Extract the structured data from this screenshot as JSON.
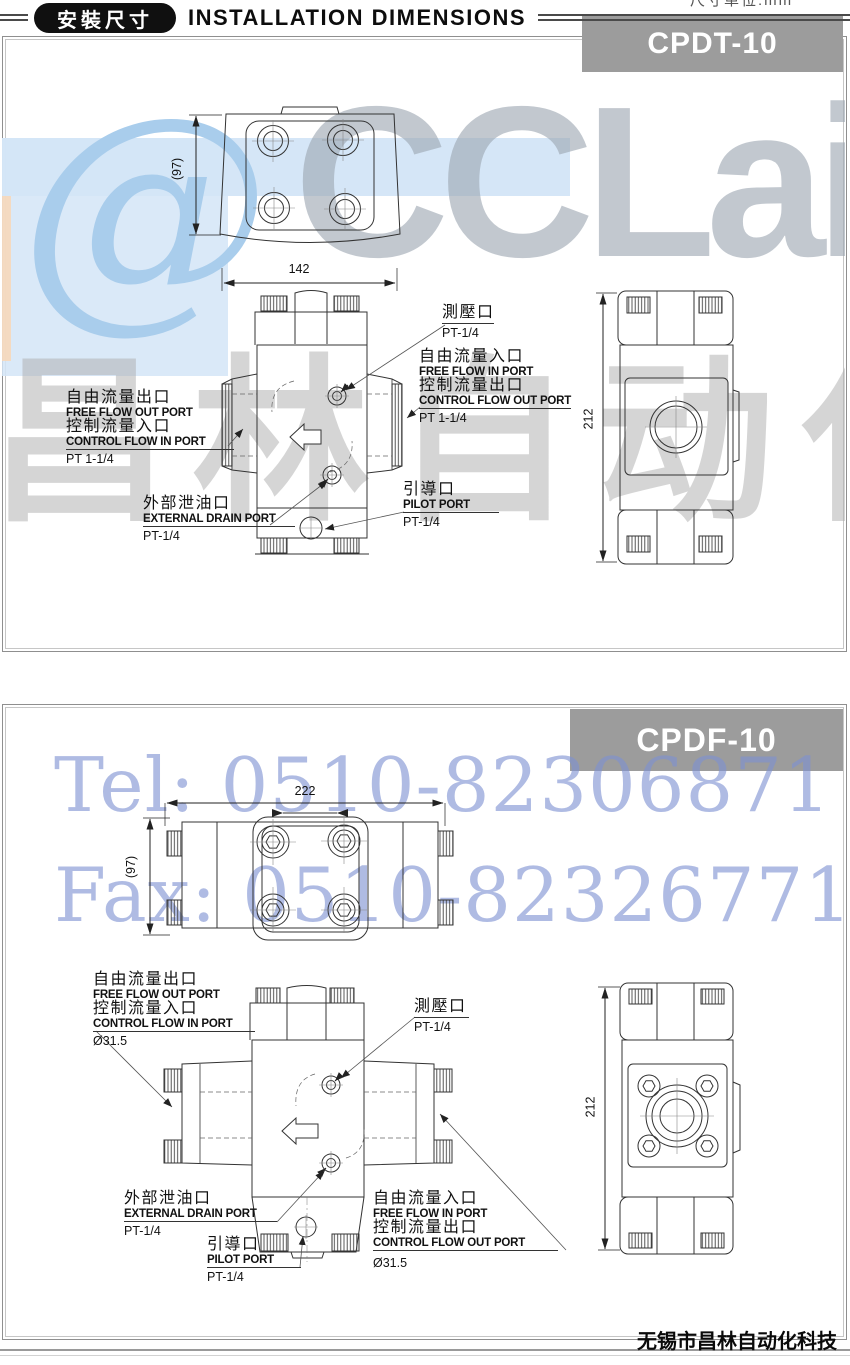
{
  "header": {
    "badge_cn": "安裝尺寸",
    "title": "INSTALLATION DIMENSIONS",
    "unit_note": "尺寸单位:mm"
  },
  "footer": {
    "company": "无锡市昌林自动化科技"
  },
  "watermarks": {
    "logo_at": "@",
    "logo_text": "CCLair",
    "logo_cn": "昌林自动化",
    "tel": "Tel: 0510-82306871",
    "fax": "Fax: 0510-82326771"
  },
  "colors": {
    "badge_bg": "#9c9c9c",
    "panel_border": "#8f8f8f",
    "watermark_blue": "#7e92d2",
    "watermark_light_blue": "#d3e5f7",
    "watermark_gray": "#a8a8a8",
    "drawing_line": "#333333"
  },
  "panel1": {
    "model": "CPDT-10",
    "dims": {
      "width": "142",
      "depth": "(97)",
      "height": "212"
    },
    "labels": {
      "flow_left": {
        "l1": "自由流量出口",
        "l2": "FREE FLOW OUT PORT",
        "l3": "控制流量入口",
        "l4": "CONTROL FLOW IN PORT",
        "size": "PT 1-1/4"
      },
      "gauge": {
        "l1": "測壓口",
        "size": "PT-1/4"
      },
      "flow_right": {
        "l1": "自由流量入口",
        "l2": "FREE FLOW IN PORT",
        "l3": "控制流量出口",
        "l4": "CONTROL FLOW OUT PORT",
        "size": "PT 1-1/4"
      },
      "pilot": {
        "l1": "引導口",
        "l2": "PILOT PORT",
        "size": "PT-1/4"
      },
      "drain": {
        "l1": "外部泄油口",
        "l2": "EXTERNAL DRAIN PORT",
        "size": "PT-1/4"
      }
    }
  },
  "panel2": {
    "model": "CPDF-10",
    "dims": {
      "width": "222",
      "depth": "(97)",
      "height": "212"
    },
    "labels": {
      "flow_left": {
        "l1": "自由流量出口",
        "l2": "FREE FLOW OUT PORT",
        "l3": "控制流量入口",
        "l4": "CONTROL FLOW IN PORT",
        "size": "Ø31.5"
      },
      "gauge": {
        "l1": "測壓口",
        "size": "PT-1/4"
      },
      "flow_right": {
        "l1": "自由流量入口",
        "l2": "FREE FLOW IN PORT",
        "l3": "控制流量出口",
        "l4": "CONTROL FLOW OUT PORT",
        "size": "Ø31.5"
      },
      "pilot": {
        "l1": "引導口",
        "l2": "PILOT PORT",
        "size": "PT-1/4"
      },
      "drain": {
        "l1": "外部泄油口",
        "l2": "EXTERNAL DRAIN PORT",
        "size": "PT-1/4"
      }
    }
  }
}
